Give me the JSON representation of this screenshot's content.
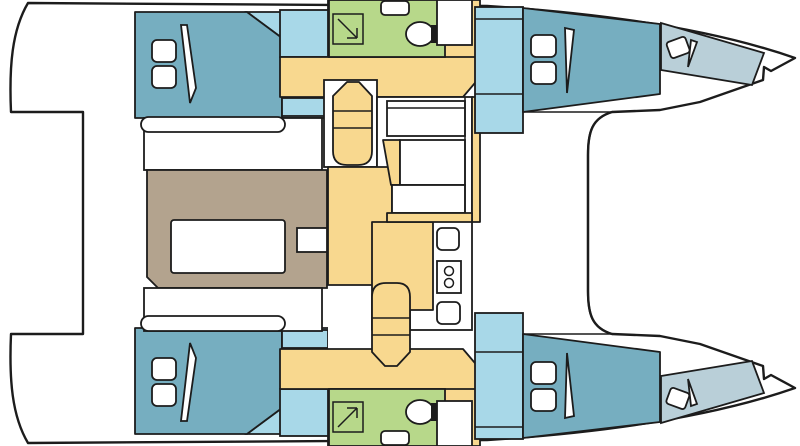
{
  "document": {
    "title": "Catamaran deck plan — 4 cabins, 2 bathrooms",
    "orientation": "bows to the right, swim platforms to the left"
  },
  "palette": {
    "hull-white": "#ffffff",
    "outline": "#1c1c1c",
    "bed-teal": "#76aec0",
    "floor-blue": "#a8d8e8",
    "forepeak-blue": "#b9cfd8",
    "bath-green": "#b7d88a",
    "galley-yellow": "#f8d88f",
    "dinette-brown": "#b3a38e"
  },
  "legend": {
    "bed-teal": "double berths (4 cabins)",
    "floor-blue": "cabin floors, wardrobes and companionway steps",
    "forepeak-blue": "forepeak berths in the bows",
    "bath-green": "bathrooms with shower, toilet and sink (2)",
    "galley-yellow": "galley counters, corridors and seats",
    "dinette-brown": "dinette / cockpit area with table",
    "hull-white": "deck, benches, table, appliances, pillows"
  },
  "rooms": [
    {
      "name": "port-aft-cabin",
      "fixtures": [
        "double-bed",
        "pillows",
        "wardrobe"
      ]
    },
    {
      "name": "port-bathroom",
      "fixtures": [
        "shower",
        "toilet",
        "sink",
        "cabinet"
      ]
    },
    {
      "name": "port-forward-cabin",
      "fixtures": [
        "double-bed",
        "pillows",
        "forepeak-berth"
      ]
    },
    {
      "name": "starboard-aft-cabin",
      "fixtures": [
        "double-bed",
        "pillows",
        "wardrobe"
      ]
    },
    {
      "name": "starboard-bathroom",
      "fixtures": [
        "shower",
        "toilet",
        "sink",
        "cabinet"
      ]
    },
    {
      "name": "starboard-forward-cabin",
      "fixtures": [
        "double-bed",
        "pillows",
        "forepeak-berth"
      ]
    },
    {
      "name": "saloon-galley",
      "fixtures": [
        "galley-sink",
        "two-burner-stove",
        "galley-unit",
        "fridge-units",
        "chart-seat",
        "counter"
      ]
    },
    {
      "name": "dinette",
      "fixtures": [
        "table",
        "bench-seats"
      ]
    },
    {
      "name": "foredeck-trampoline",
      "fixtures": []
    },
    {
      "name": "swim-platforms",
      "fixtures": []
    }
  ]
}
